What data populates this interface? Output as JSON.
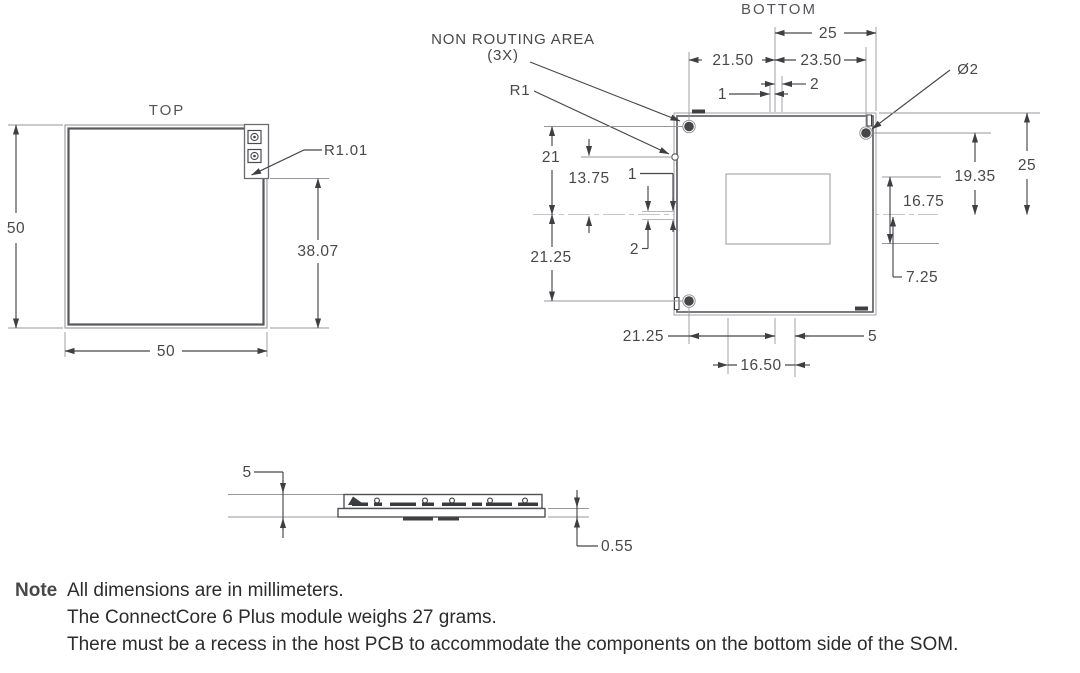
{
  "colors": {
    "note_green": "#8dc63f",
    "line_gray": "#46474b",
    "body_text": "#2c2c2c"
  },
  "views": {
    "top": {
      "title": "TOP",
      "dim_height": "50",
      "dim_width": "50",
      "dim_notch_height": "38.07",
      "callout_corner_radius": "R1.01"
    },
    "bottom": {
      "title": "BOTTOM",
      "callouts": {
        "non_routing_area": "NON ROUTING AREA",
        "non_routing_qty": "(3X)",
        "edge_radius": "R1",
        "hole_diameter": "Ø2"
      },
      "dims": {
        "top_25": "25",
        "top_21_50": "21.50",
        "top_23_50": "23.50",
        "top_2": "2",
        "top_1": "1",
        "left_21": "21",
        "left_13_75": "13.75",
        "left_1": "1",
        "left_21_25": "21.25",
        "left_2": "2",
        "right_25": "25",
        "right_19_35": "19.35",
        "right_16_75": "16.75",
        "right_7_25": "7.25",
        "bottom_21_25": "21.25",
        "bottom_16_50": "16.50",
        "bottom_5": "5"
      }
    },
    "side": {
      "dim_height": "5",
      "dim_pcb_thickness": "0.55"
    }
  },
  "note": {
    "label": "Note",
    "lines": [
      "All dimensions are in millimeters.",
      "The ConnectCore 6 Plus module weighs 27 grams.",
      "There must be a recess in the host PCB to accommodate the components on the bottom side of the SOM."
    ]
  }
}
